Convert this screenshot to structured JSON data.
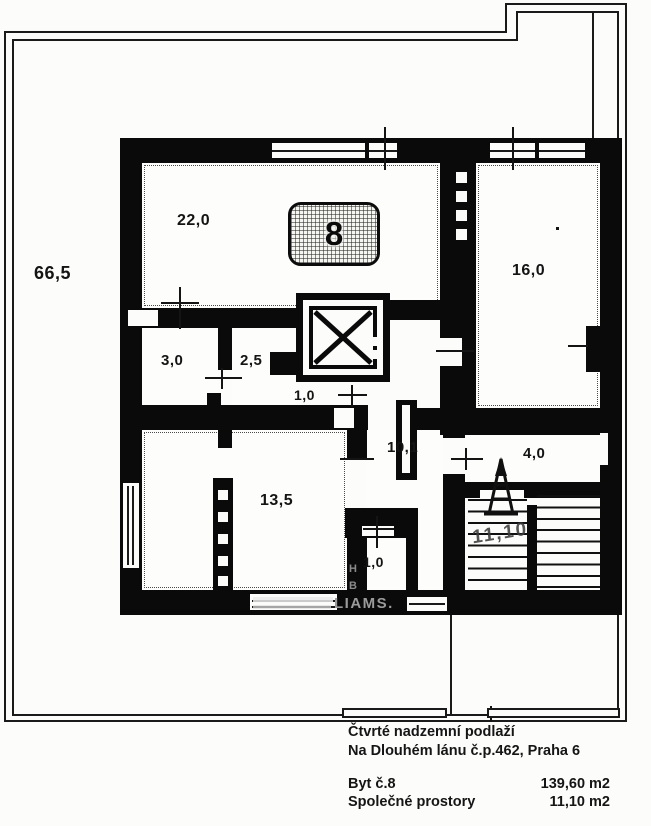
{
  "plan": {
    "badge": {
      "number": "8"
    },
    "rooms": {
      "terrace": "66,5",
      "living": "22,0",
      "room_right": "16,0",
      "bath": "3,0",
      "wc": "2,5",
      "hall": "1,0",
      "corridor": "10,1",
      "bedroom": "13,5",
      "closet": "1,0",
      "entry": "4,0",
      "stairs": "11,10"
    },
    "watermark": {
      "fragment_main": "LIAMS.",
      "fragment_h": "H",
      "fragment_b": "B"
    }
  },
  "footer": {
    "line1": "Čtvrté nadzemní podlaží",
    "line2": "Na Dlouhém lánu č.p.462, Praha 6",
    "rows": [
      {
        "label": "Byt č.8",
        "value": "139,60 m2"
      },
      {
        "label": "Společné prostory",
        "value": "11,10 m2"
      }
    ]
  },
  "colors": {
    "wall": "#0a0a0a",
    "paper": "#fcfcfa",
    "watermark": "#9b9b9b"
  }
}
